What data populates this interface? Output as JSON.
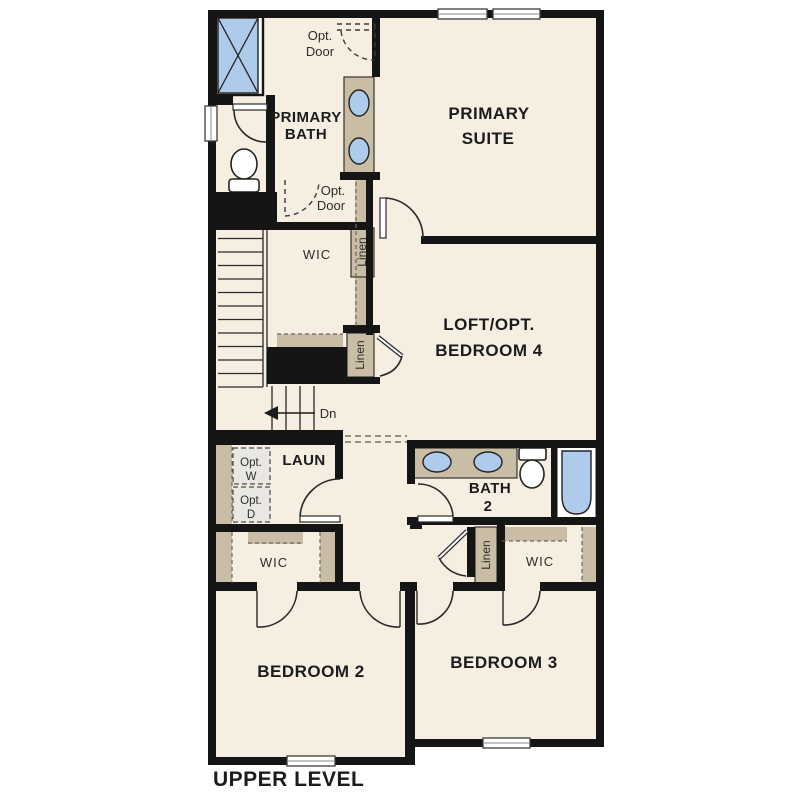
{
  "plan": {
    "title": "UPPER LEVEL",
    "labels": {
      "primary_bath": [
        "PRIMARY",
        "BATH"
      ],
      "primary_suite": [
        "PRIMARY",
        "SUITE"
      ],
      "loft": [
        "LOFT/OPT.",
        "BEDROOM 4"
      ],
      "bedroom2": "BEDROOM 2",
      "bedroom3": "BEDROOM 3",
      "bath2": [
        "BATH",
        "2"
      ],
      "laundry": "LAUN",
      "wic_primary": "WIC",
      "wic_bedroom2": "WIC",
      "wic_bedroom3": "WIC",
      "linen_1": "Linen",
      "linen_2": "Linen",
      "linen_3": "Linen",
      "opt_door_top": [
        "Opt.",
        "Door"
      ],
      "opt_door_wic": [
        "Opt.",
        "Door"
      ],
      "opt_washer": [
        "Opt.",
        "W"
      ],
      "opt_dryer": [
        "Opt.",
        "D"
      ],
      "stairs_down": "Dn"
    },
    "colors": {
      "floor": "#f5eee1",
      "wall": "#151515",
      "cabinet": "#c9bda6",
      "fixture_blue": "#aecbeb",
      "optional_fill": "#e8e7e3"
    }
  }
}
